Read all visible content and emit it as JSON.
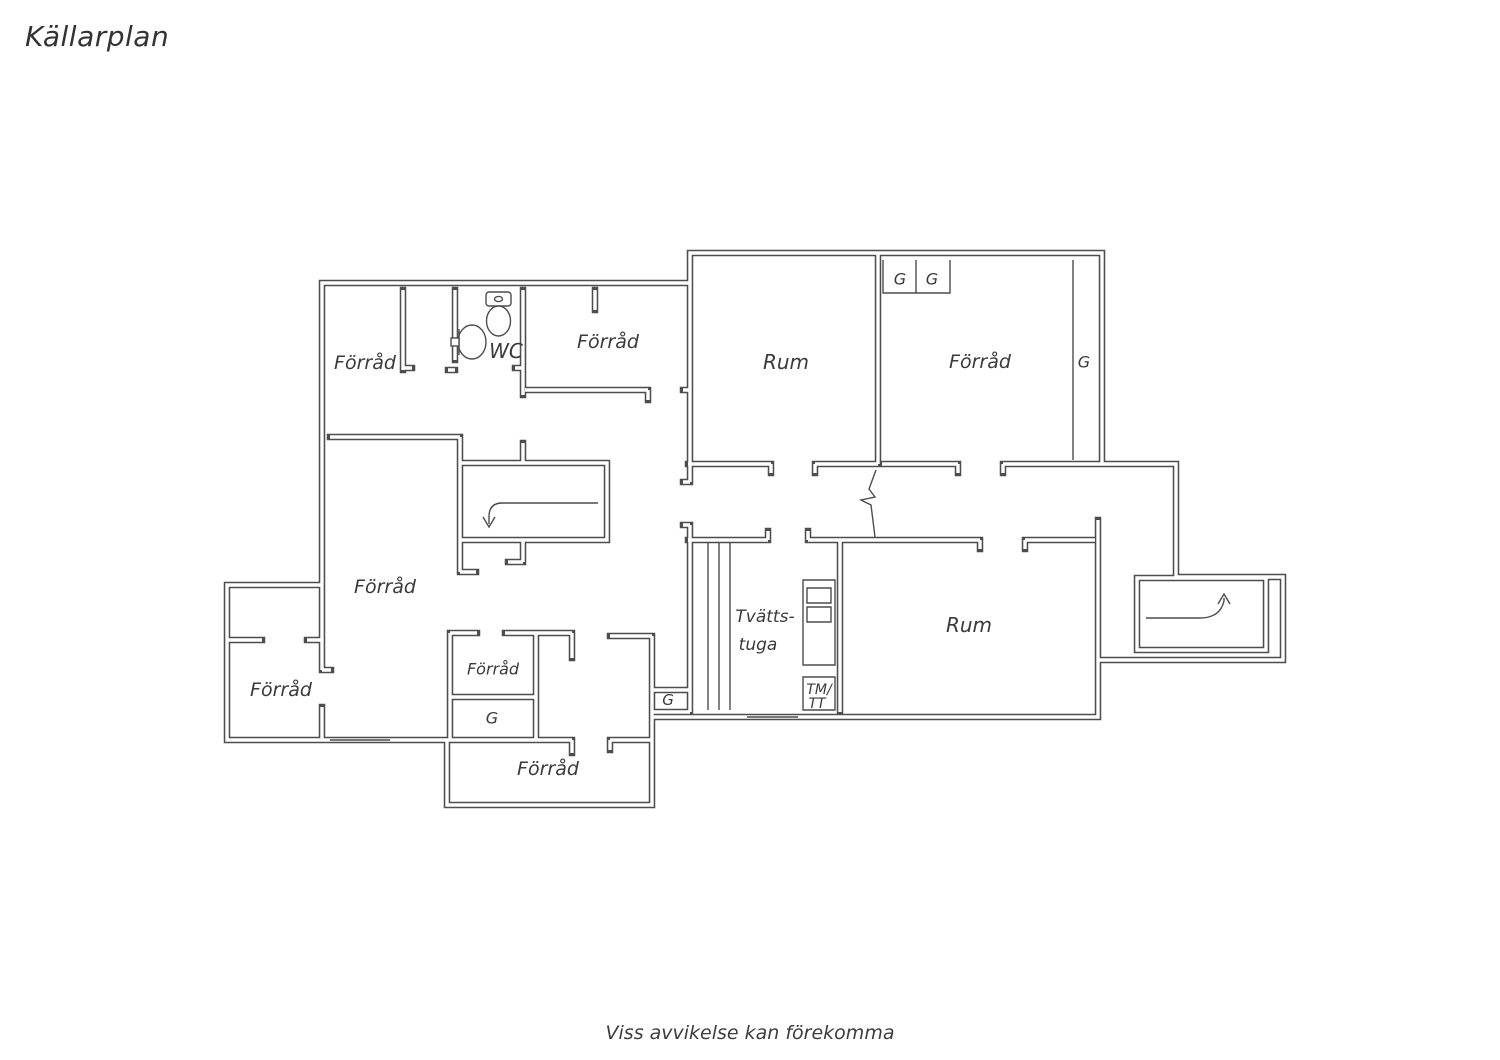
{
  "page": {
    "title": "Källarplan",
    "footer": "Viss avvikelse kan förekomma",
    "background": "#ffffff",
    "line_color": "#4d4d4d",
    "text_color": "#3a3a3a"
  },
  "floorplan": {
    "floor_name": "Källarplan",
    "labels": [
      {
        "id": "forrad-top-left",
        "text": "Förråd",
        "x": 365,
        "y": 363,
        "fs": 19
      },
      {
        "id": "wc",
        "text": "WC",
        "x": 506,
        "y": 351,
        "fs": 20
      },
      {
        "id": "forrad-top-mid",
        "text": "Förråd",
        "x": 608,
        "y": 342,
        "fs": 19
      },
      {
        "id": "rum-top",
        "text": "Rum",
        "x": 786,
        "y": 362,
        "fs": 20
      },
      {
        "id": "forrad-top-right",
        "text": "Förråd",
        "x": 980,
        "y": 362,
        "fs": 19
      },
      {
        "id": "g-closet-1",
        "text": "G",
        "x": 900,
        "y": 279,
        "fs": 16
      },
      {
        "id": "g-closet-2",
        "text": "G",
        "x": 932,
        "y": 279,
        "fs": 16
      },
      {
        "id": "g-closet-right",
        "text": "G",
        "x": 1084,
        "y": 362,
        "fs": 16
      },
      {
        "id": "forrad-central",
        "text": "Förråd",
        "x": 385,
        "y": 587,
        "fs": 19
      },
      {
        "id": "forrad-bottom-left",
        "text": "Förråd",
        "x": 281,
        "y": 690,
        "fs": 19
      },
      {
        "id": "forrad-small",
        "text": "Förråd",
        "x": 493,
        "y": 669,
        "fs": 16
      },
      {
        "id": "g-closet-small",
        "text": "G",
        "x": 492,
        "y": 718,
        "fs": 16
      },
      {
        "id": "g-closet-hall",
        "text": "G",
        "x": 668,
        "y": 700,
        "fs": 15
      },
      {
        "id": "forrad-bottom",
        "text": "Förråd",
        "x": 548,
        "y": 769,
        "fs": 19
      },
      {
        "id": "tvattstuga-line1",
        "text": "Tvätts-",
        "x": 765,
        "y": 617,
        "fs": 17
      },
      {
        "id": "tvattstuga-line2",
        "text": "tuga",
        "x": 758,
        "y": 645,
        "fs": 17
      },
      {
        "id": "rum-bottom",
        "text": "Rum",
        "x": 969,
        "y": 625,
        "fs": 20
      },
      {
        "id": "tm-tt-line1",
        "text": "TM/",
        "x": 819,
        "y": 690,
        "fs": 14
      },
      {
        "id": "tm-tt-line2",
        "text": "TT",
        "x": 817,
        "y": 704,
        "fs": 14
      }
    ],
    "fixtures": [
      "toilet",
      "washbasin",
      "laundry-counter-with-sinks",
      "tm-tt-cabinet",
      "wardrobe-closets",
      "stairs-down-arrow",
      "entry-stairs-up-arrow",
      "windows",
      "opening-break-line"
    ]
  }
}
